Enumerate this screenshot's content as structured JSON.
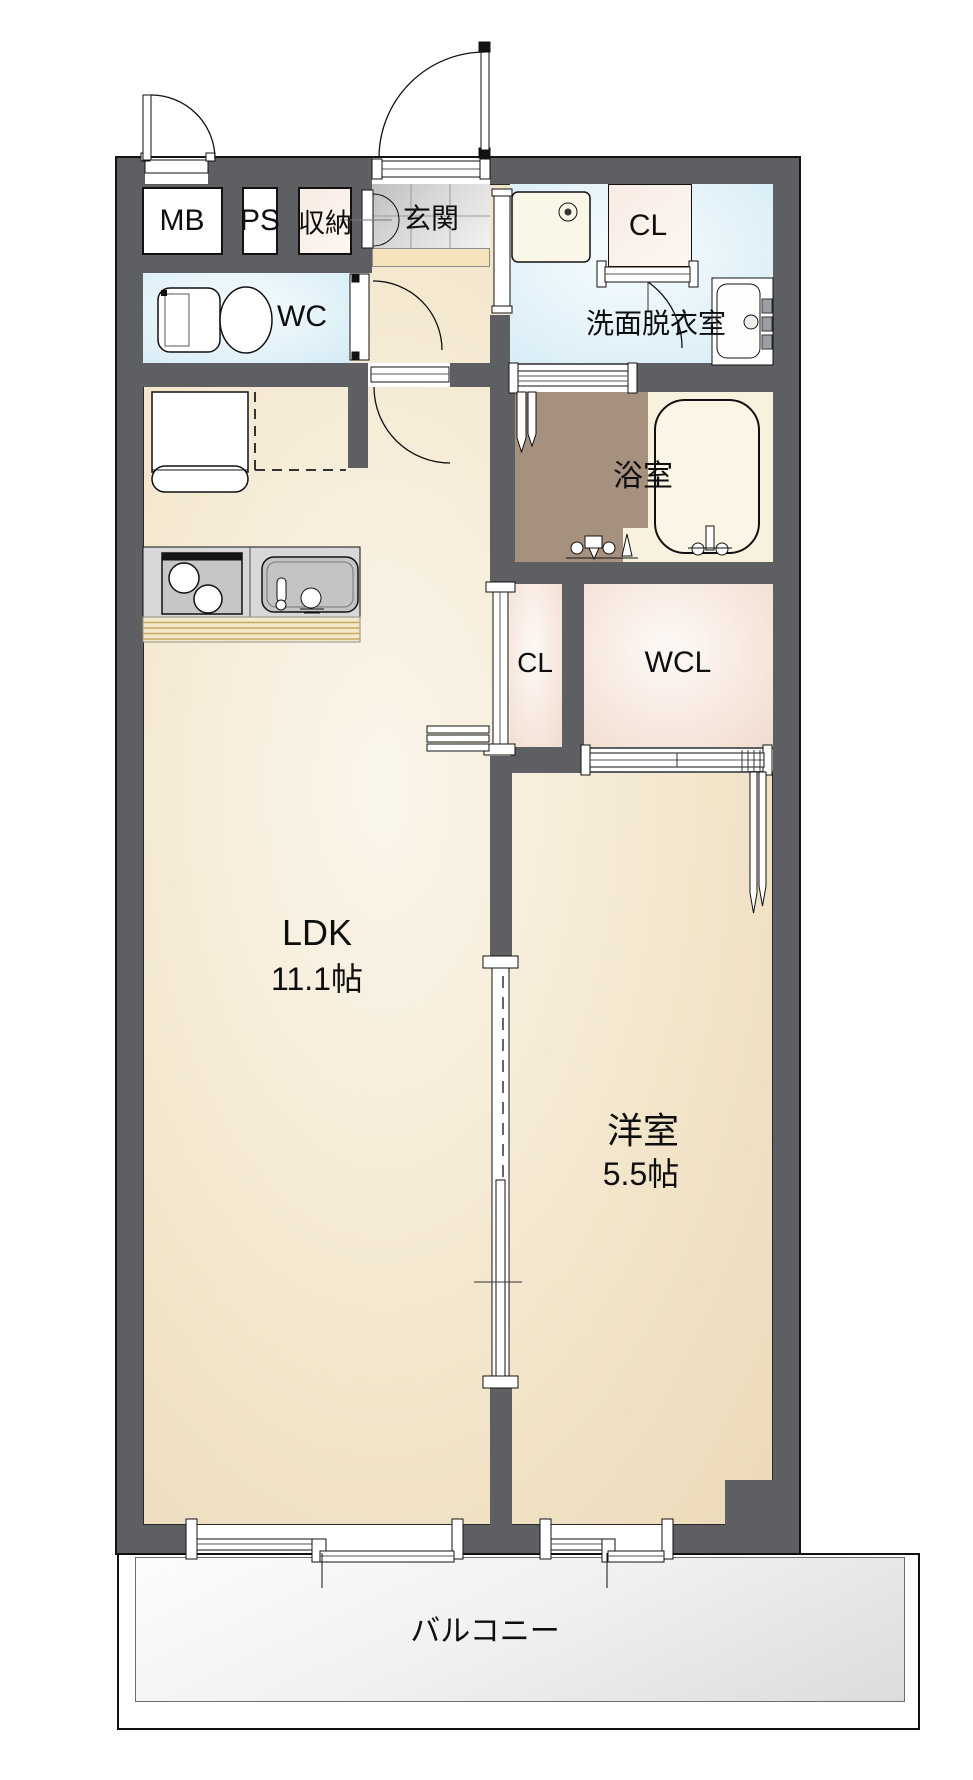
{
  "floorplan": {
    "labels": {
      "mb": "MB",
      "ps": "PS",
      "storage": "収納",
      "entrance": "玄関",
      "wc": "WC",
      "closet_upper": "CL",
      "washroom": "洗面脱衣室",
      "bathroom": "浴室",
      "closet_middle": "CL",
      "walk_in_closet": "WCL",
      "ldk": "LDK",
      "ldk_area": "11.1帖",
      "western_room": "洋室",
      "western_room_area": "5.5帖",
      "balcony": "バルコニー"
    },
    "colors": {
      "wall": "#5e5f62",
      "floor_cream": "#f3e6cc",
      "room_blue": "#e3f2f9",
      "room_pink": "#f6e6dc",
      "bath_floor_brown": "#a5917e",
      "entrance_tile": "#d9d9d9",
      "step_beige": "#f6e3bb",
      "balcony_gray": "#ececec"
    }
  }
}
